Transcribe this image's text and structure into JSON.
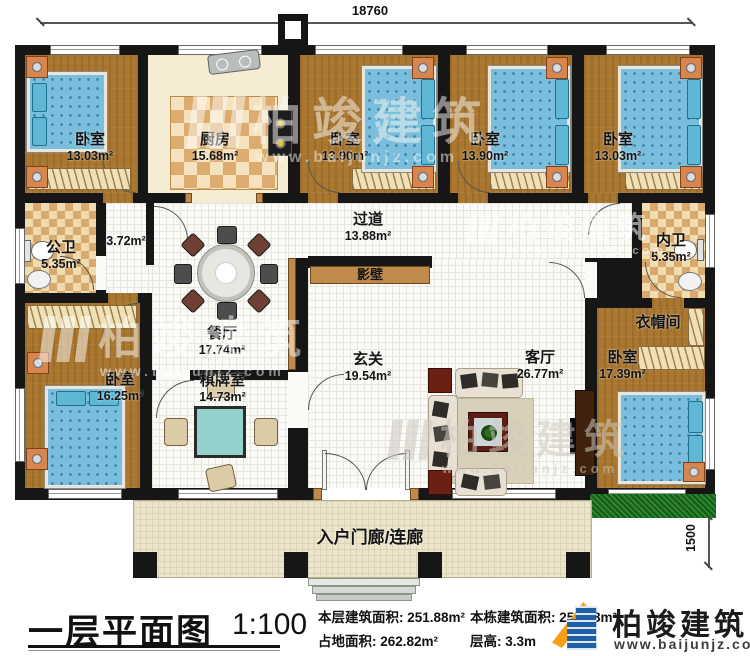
{
  "dimensions": {
    "top": "18760",
    "right": "12160",
    "right_lower": "600",
    "right_lowest": "1500"
  },
  "rooms": {
    "bedroom_tl": {
      "name": "卧室",
      "area": "13.03m²"
    },
    "kitchen": {
      "name": "厨房",
      "area": "15.68m²"
    },
    "bedroom_t2": {
      "name": "卧室",
      "area": "13.90m²"
    },
    "bedroom_t3": {
      "name": "卧室",
      "area": "13.90m²"
    },
    "bedroom_tr": {
      "name": "卧室",
      "area": "13.03m²"
    },
    "public_bath": {
      "name": "公卫",
      "area": "5.35m²"
    },
    "small_hall": {
      "area": "3.72m²"
    },
    "dining": {
      "name": "餐厅",
      "area": "17.74m²"
    },
    "corridor": {
      "name": "过道",
      "area": "13.88m²"
    },
    "screen_wall": {
      "name": "影壁"
    },
    "inner_bath": {
      "name": "内卫",
      "area": "5.35m²"
    },
    "cloakroom": {
      "name": "衣帽间"
    },
    "bedroom_bl": {
      "name": "卧室",
      "area": "16.25m²"
    },
    "chess_room": {
      "name": "棋牌室",
      "area": "14.73m²"
    },
    "foyer": {
      "name": "玄关",
      "area": "19.54m²"
    },
    "living": {
      "name": "客厅",
      "area": "26.77m²"
    },
    "bedroom_br": {
      "name": "卧室",
      "area": "17.39m²"
    },
    "porch": {
      "name": "入户门廊/连廊"
    }
  },
  "title_block": {
    "plan_title": "一层平面图",
    "scale": "1:100",
    "floor_area_label": "本层建筑面积:",
    "floor_area_value": "251.88m²",
    "land_area_label": "占地面积:",
    "land_area_value": "262.82m²",
    "building_area_label": "本栋建筑面积:",
    "building_area_value": "251.88m²",
    "height_label": "层高:",
    "height_value": "3.3m"
  },
  "logo": {
    "name": "柏竣建筑",
    "url": "www.baijunjz.com"
  },
  "watermark": {
    "text": "柏竣建筑",
    "url": "www.baijunjz.com"
  },
  "colors": {
    "wall": "#161616",
    "wood": "#a97730",
    "accent": "#c08b4a",
    "bed": "#79bedd",
    "logo_blue": "#1f5fa8",
    "logo_orange": "#f6a01a"
  }
}
